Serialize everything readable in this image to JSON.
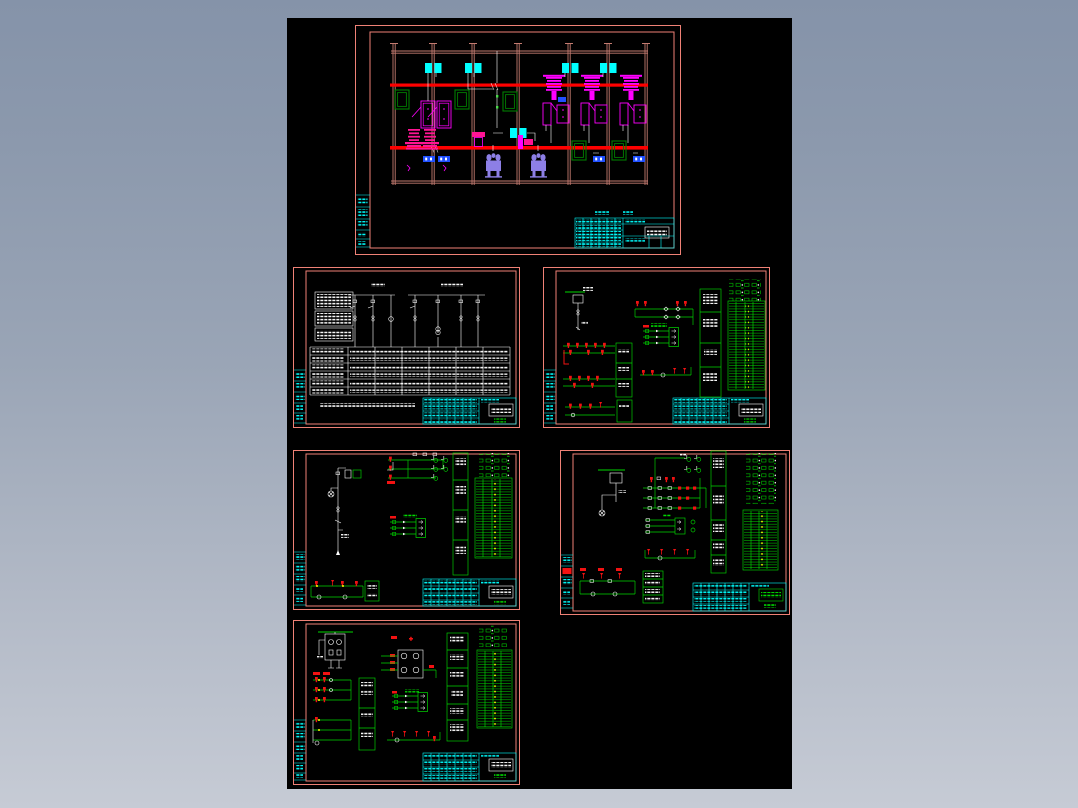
{
  "viewer": {
    "name": "CAD drawing preview",
    "description": "Black model-space canvas with six bordered electrical drawing sheets (substation primary layout, single-line diagram with data table, and four secondary wiring schematics)."
  },
  "palette": {
    "page_bg_top": "#8593a9",
    "page_bg_bottom": "#c6cbd5",
    "canvas_bg": "#000000",
    "sheet_border_salmon": "#ef8176",
    "structure_grid_salmon": "#c47b70",
    "busbar_red": "#ff0000",
    "symbol_red": "#f21212",
    "equipment_magenta": "#ff00ff",
    "equipment_deep_pink": "#ff1493",
    "annotation_cyan": "#00ffff",
    "circuit_green": "#00d800",
    "dark_green": "#007d00",
    "device_blue": "#2050ff",
    "transformer_purple": "#8d7fe6",
    "terminal_yellow": "#ffff00",
    "line_white": "#ffffff"
  },
  "canvas": {
    "style": "left:287px;top:18px;width:505px;height:771px"
  },
  "sheets": [
    {
      "id": "sheet-a",
      "name": "Substation layout / section drawing with busbars, breakers and transformers",
      "style": "left:68px;top:7px;width:326px;height:230px"
    },
    {
      "id": "sheet-b",
      "name": "Primary single-line diagram with equipment schedule table",
      "style": "left:6px;top:249px;width:227px;height:161px"
    },
    {
      "id": "sheet-c",
      "name": "Secondary wiring schematic sheet 1 with terminal strips",
      "style": "left:256px;top:249px;width:227px;height:161px"
    },
    {
      "id": "sheet-d",
      "name": "Secondary wiring schematic sheet 2 with lamp circuits",
      "style": "left:6px;top:432px;width:227px;height:160px"
    },
    {
      "id": "sheet-e",
      "name": "Secondary wiring schematic sheet 3 with relay ladder",
      "style": "left:273px;top:432px;width:230px;height:165px"
    },
    {
      "id": "sheet-f",
      "name": "Secondary wiring schematic sheet 4 with transformer block",
      "style": "left:6px;top:602px;width:227px;height:165px"
    }
  ]
}
